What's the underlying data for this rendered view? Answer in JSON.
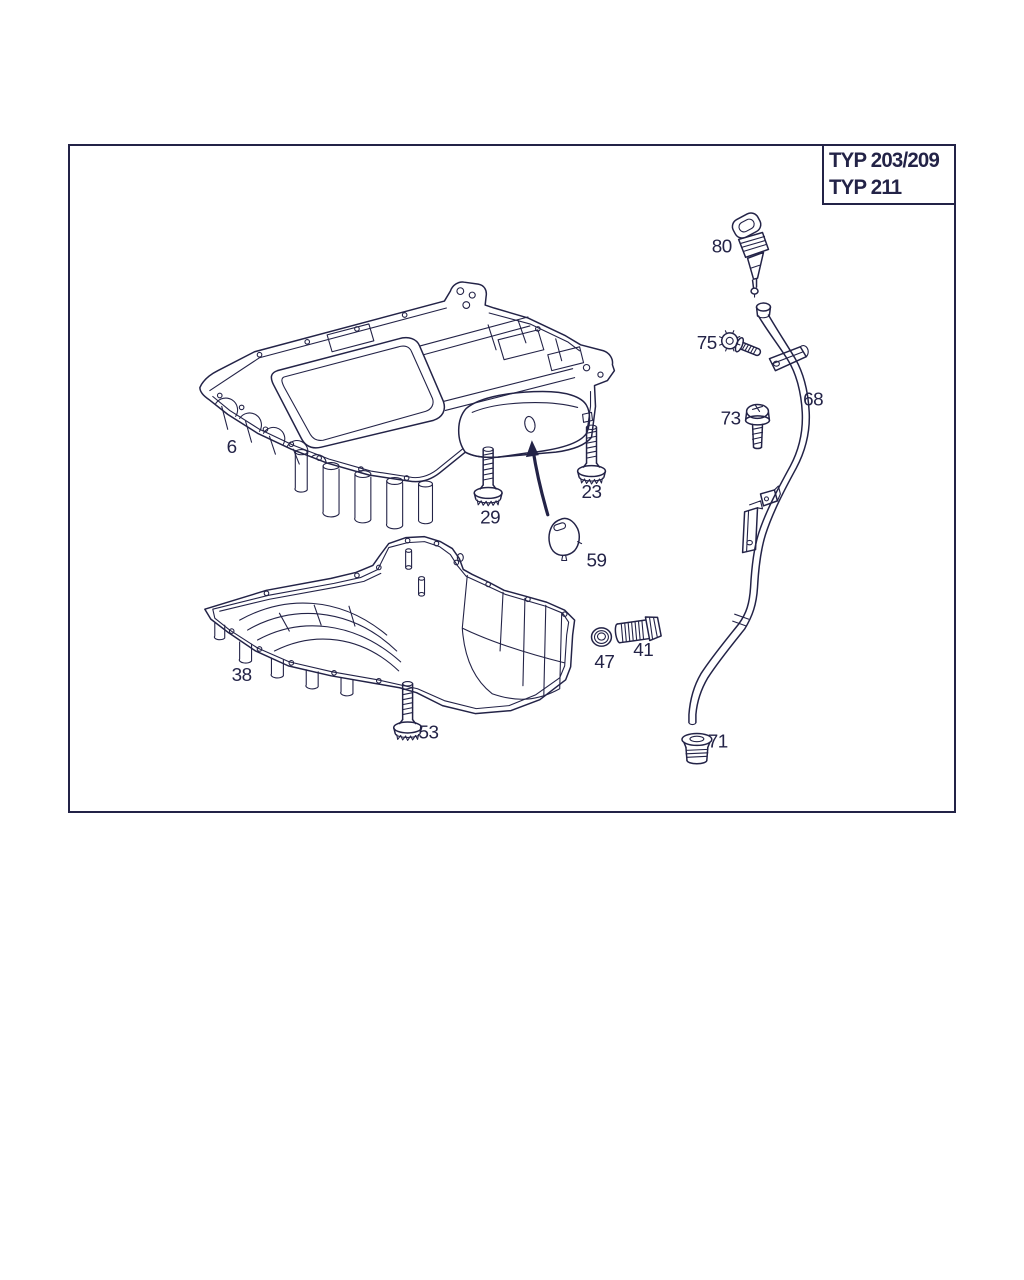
{
  "diagram": {
    "type_box": {
      "line1": "TYP 203/209",
      "line2": "TYP 211"
    },
    "colors": {
      "ink": "#232347",
      "background": "#ffffff"
    },
    "part_labels": {
      "p6": "6",
      "p23": "23",
      "p29": "29",
      "p38": "38",
      "p41": "41",
      "p47": "47",
      "p53": "53",
      "p59": "59",
      "p68": "68",
      "p71": "71",
      "p73": "73",
      "p75": "75",
      "p80": "80"
    }
  }
}
